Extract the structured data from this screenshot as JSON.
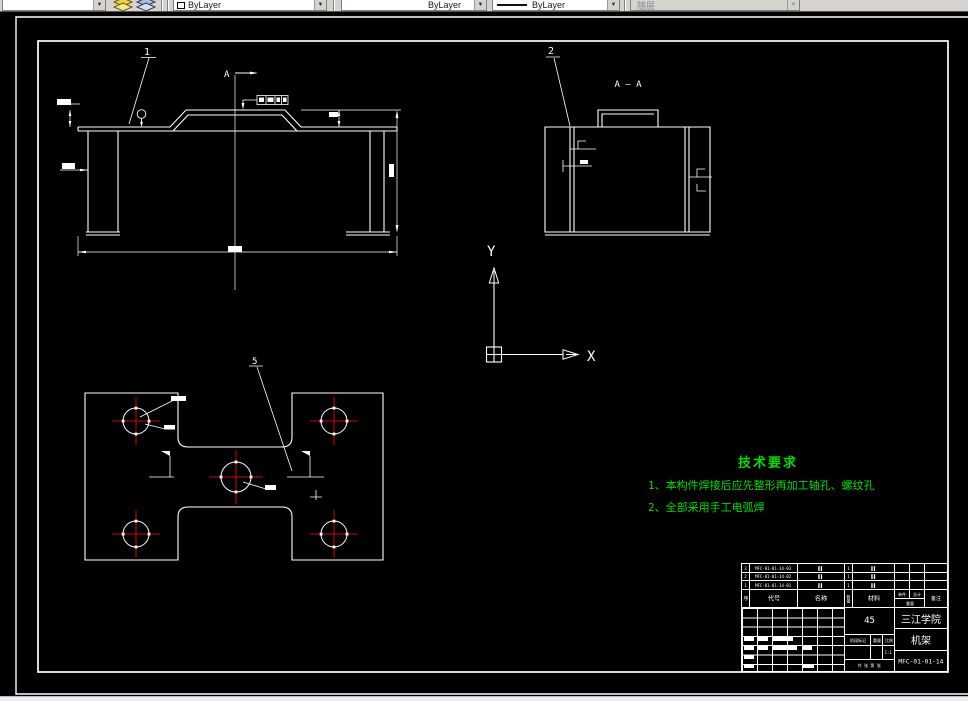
{
  "colors": {
    "canvas_background": "#000000",
    "drawing_lines": "#ffffff",
    "centerlines": "#d40000",
    "annotation_text": "#00dd00"
  },
  "toolbar": {
    "layer_combo": {
      "dropdown": "▼"
    },
    "color_combo": {
      "label": "ByLayer",
      "dropdown": "▼"
    },
    "linetype_combo": {
      "label": "ByLayer",
      "dropdown": "▼"
    },
    "lineweight_combo": {
      "label": "ByLayer",
      "dropdown": "▼"
    },
    "plotstyle_combo": {
      "label": "随层",
      "dropdown": "▼"
    }
  },
  "ucs": {
    "x_label": "X",
    "y_label": "Y"
  },
  "drawing": {
    "balloon_front": "1",
    "balloon_section": "2",
    "balloon_plan": "5",
    "section_arrow_label": "A",
    "section_title": "A — A"
  },
  "tech_req": {
    "title": "技术要求",
    "items": [
      "1、本构件焊接后应先整形再加工轴孔、螺纹孔",
      "2、全部采用手工电弧焊"
    ]
  },
  "title_block": {
    "bom_rows": [
      {
        "seq": "3",
        "code": "MFC-01-01-14-03",
        "name": "▌▌",
        "qty": "1",
        "material": "▌▌"
      },
      {
        "seq": "2",
        "code": "MFC-01-01-14-02",
        "name": "▌▌",
        "qty": "1",
        "material": "▌▌"
      },
      {
        "seq": "1",
        "code": "MFC-01-01-14-01",
        "name": "▌▌",
        "qty": "1",
        "material": "▌▌"
      }
    ],
    "bom_header": {
      "seq": "序",
      "code": "代号",
      "name": "名称",
      "qty": "数量",
      "material": "材料",
      "unit": "单件",
      "total": "总计",
      "weight": "重量",
      "remark": "备注"
    },
    "material_grade": "45",
    "company": "三江学院",
    "part_name": "机架",
    "drawing_number": "MFC-01-01-14",
    "stage_label": "阶段标记",
    "weight_label": "重量",
    "scale_label": "比例",
    "scale_value": "1:1",
    "sheet_label": "共 张 第 张"
  }
}
